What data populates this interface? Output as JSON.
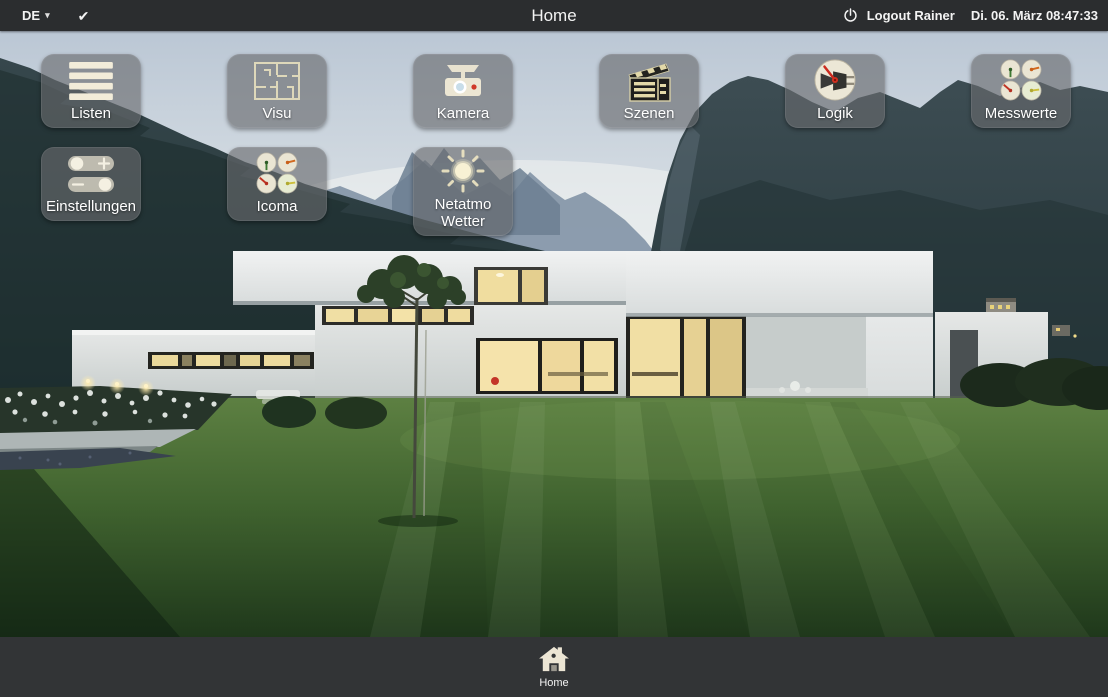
{
  "topbar": {
    "language": "DE",
    "title": "Home",
    "logout": "Logout Rainer",
    "datetime": "Di. 06. März 08:47:33",
    "icons": {
      "caret_down": "▾",
      "checkmark": "✔",
      "power": "power-icon"
    }
  },
  "tiles": [
    {
      "label": "Listen",
      "icon": "list-icon"
    },
    {
      "label": "Visu",
      "icon": "floorplan-icon"
    },
    {
      "label": "Kamera",
      "icon": "camera-icon"
    },
    {
      "label": "Szenen",
      "icon": "clapperboard-icon"
    },
    {
      "label": "Logik",
      "icon": "logic-gauge-icon"
    },
    {
      "label": "Messwerte",
      "icon": "gauges-icon"
    },
    {
      "label": "Einstellungen",
      "icon": "sliders-icon"
    },
    {
      "label": "Icoma",
      "icon": "gauges-icon"
    },
    {
      "label": "Netatmo Wetter",
      "icon": "sun-icon"
    }
  ],
  "bottombar": {
    "home": "Home",
    "icon": "home-icon"
  },
  "colors": {
    "bar_bg": "#2b2d2f",
    "bottom_bar_bg": "#323436",
    "tile_bg": "rgba(104,106,110,0.63)",
    "tile_text": "#ffffff",
    "icon_cream": "#eee8d5",
    "window_glow": "#f2dfa2",
    "accent_red": "#cf3423",
    "lawn_green": "#40632f",
    "sky": "#c3cedb"
  }
}
